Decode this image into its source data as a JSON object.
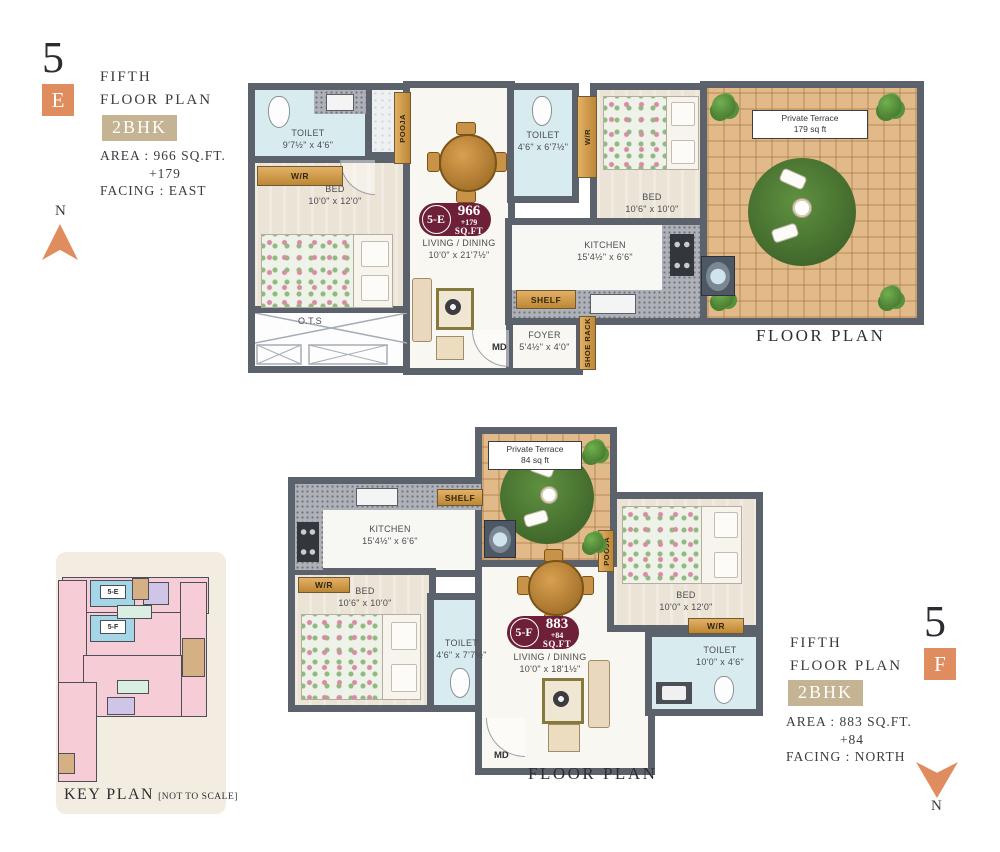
{
  "colors": {
    "accent_orange": "#df8c5e",
    "badge_maroon": "#6d2038",
    "bhk_tan": "#c5b494",
    "wall_gray": "#5c626c"
  },
  "plan_e": {
    "floor_number": "5",
    "unit_letter": "E",
    "title_line1": "FIFTH",
    "title_line2": "FLOOR PLAN",
    "bhk": "2BHK",
    "area": "AREA : 966 SQ.FT.",
    "area_extra": "+179",
    "facing": "FACING : EAST",
    "compass": "N",
    "caption": "FLOOR PLAN",
    "badge": {
      "unit": "5-E",
      "sqft": "966",
      "plus": "+179",
      "suffix": "SQ.FT"
    },
    "rooms": {
      "toilet1": {
        "name": "TOILET",
        "dims": "9'7½\" x 4'6\""
      },
      "wr1": "W/R",
      "bed1": {
        "name": "BED",
        "dims": "10'0\" x 12'0\""
      },
      "ots": "O.T.S",
      "pooja": "POOJA",
      "living": {
        "name": "LIVING / DINING",
        "dims": "10'0\" x 21'7½\""
      },
      "foyer": {
        "name": "FOYER",
        "dims": "5'4½\" x 4'0\""
      },
      "shoe_rack": "SHOE RACK",
      "md": "MD",
      "toilet2": {
        "name": "TOILET",
        "dims": "4'6\" x 6'7½\""
      },
      "wr2": "W/R",
      "bed2": {
        "name": "BED",
        "dims": "10'6\" x 10'0\""
      },
      "kitchen": {
        "name": "KITCHEN",
        "dims": "15'4½\" x 6'6\""
      },
      "shelf": "SHELF",
      "terrace": {
        "name": "Private Terrace",
        "dims": "179 sq ft"
      }
    }
  },
  "plan_f": {
    "floor_number": "5",
    "unit_letter": "F",
    "title_line1": "FIFTH",
    "title_line2": "FLOOR PLAN",
    "bhk": "2BHK",
    "area": "AREA : 883 SQ.FT.",
    "area_extra": "+84",
    "facing": "FACING : NORTH",
    "compass": "N",
    "caption": "FLOOR PLAN",
    "badge": {
      "unit": "5-F",
      "sqft": "883",
      "plus": "+84",
      "suffix": "SQ.FT"
    },
    "rooms": {
      "terrace": {
        "name": "Private Terrace",
        "dims": "84 sq ft"
      },
      "shelf": "SHELF",
      "kitchen": {
        "name": "KITCHEN",
        "dims": "15'4½\" x 6'6\""
      },
      "wr1": "W/R",
      "bed1": {
        "name": "BED",
        "dims": "10'6\" x 10'0\""
      },
      "toilet1": {
        "name": "TOILET",
        "dims": "4'6\" x 7'7½\""
      },
      "pooja": "POOJA",
      "living": {
        "name": "LIVING / DINING",
        "dims": "10'0\" x 18'1½\""
      },
      "md": "MD",
      "bed2": {
        "name": "BED",
        "dims": "10'0\" x 12'0\""
      },
      "wr2": "W/R",
      "toilet2": {
        "name": "TOILET",
        "dims": "10'0\" x 4'6\""
      }
    }
  },
  "key_plan": {
    "title": "KEY PLAN",
    "note": "[NOT TO SCALE]",
    "unit_e": "5-E",
    "unit_f": "5-F"
  }
}
